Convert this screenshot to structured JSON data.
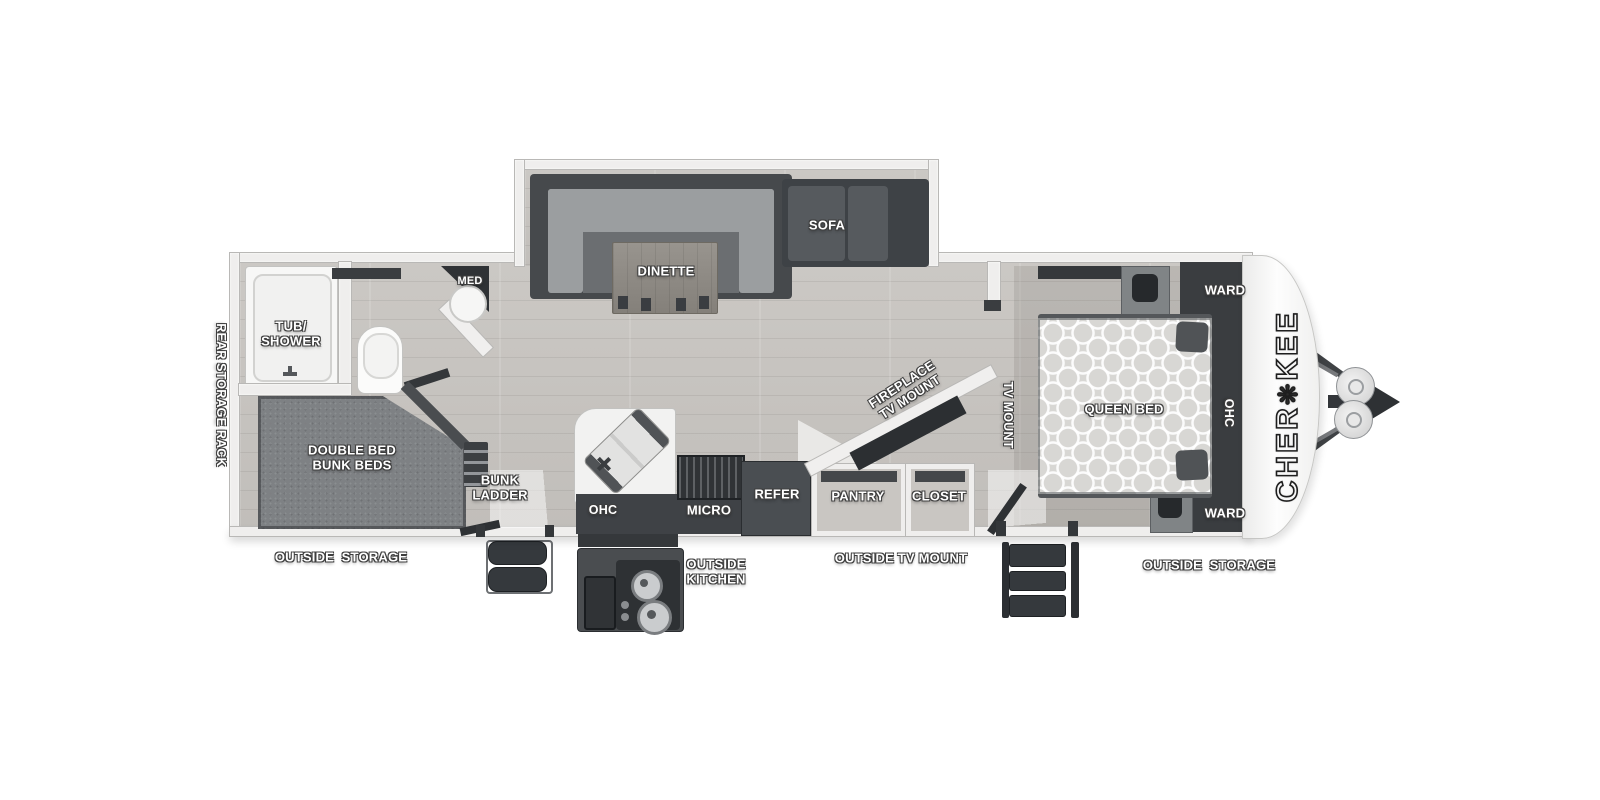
{
  "floorplan": {
    "brand": {
      "stylized": [
        "CHER",
        "❋",
        "KEE"
      ]
    },
    "slideout": {
      "dinette": "DINETTE",
      "sofa": "SOFA"
    },
    "bathroom": {
      "tub_shower": "TUB/\nSHOWER",
      "med": "MED"
    },
    "bunkroom": {
      "bed": "DOUBLE BED\nBUNK BEDS",
      "ladder": "BUNK\nLADDER"
    },
    "kitchen": {
      "ohc": "OHC",
      "micro": "MICRO",
      "refer": "REFER"
    },
    "living": {
      "fireplace_tv": "FIREPLACE\nTV MOUNT",
      "tv_mount": "TV MOUNT"
    },
    "storage": {
      "pantry": "PANTRY",
      "closet": "CLOSET"
    },
    "bedroom": {
      "queen_bed": "QUEEN BED",
      "ward_top": "WARD",
      "ohc": "OHC",
      "ward_bottom": "WARD"
    },
    "exterior": {
      "rear_rack": "REAR STORAGE RACK",
      "outside_storage_left": "OUTSIDE  STORAGE",
      "outside_kitchen": "OUTSIDE\nKITCHEN",
      "outside_tv_mount": "OUTSIDE TV MOUNT",
      "outside_storage_right": "OUTSIDE  STORAGE"
    },
    "colors": {
      "wall": "#efeeed",
      "floor_wood": "#c7c4c0",
      "furniture_dark": "#3f4246",
      "label_text": "#ffffff"
    }
  }
}
